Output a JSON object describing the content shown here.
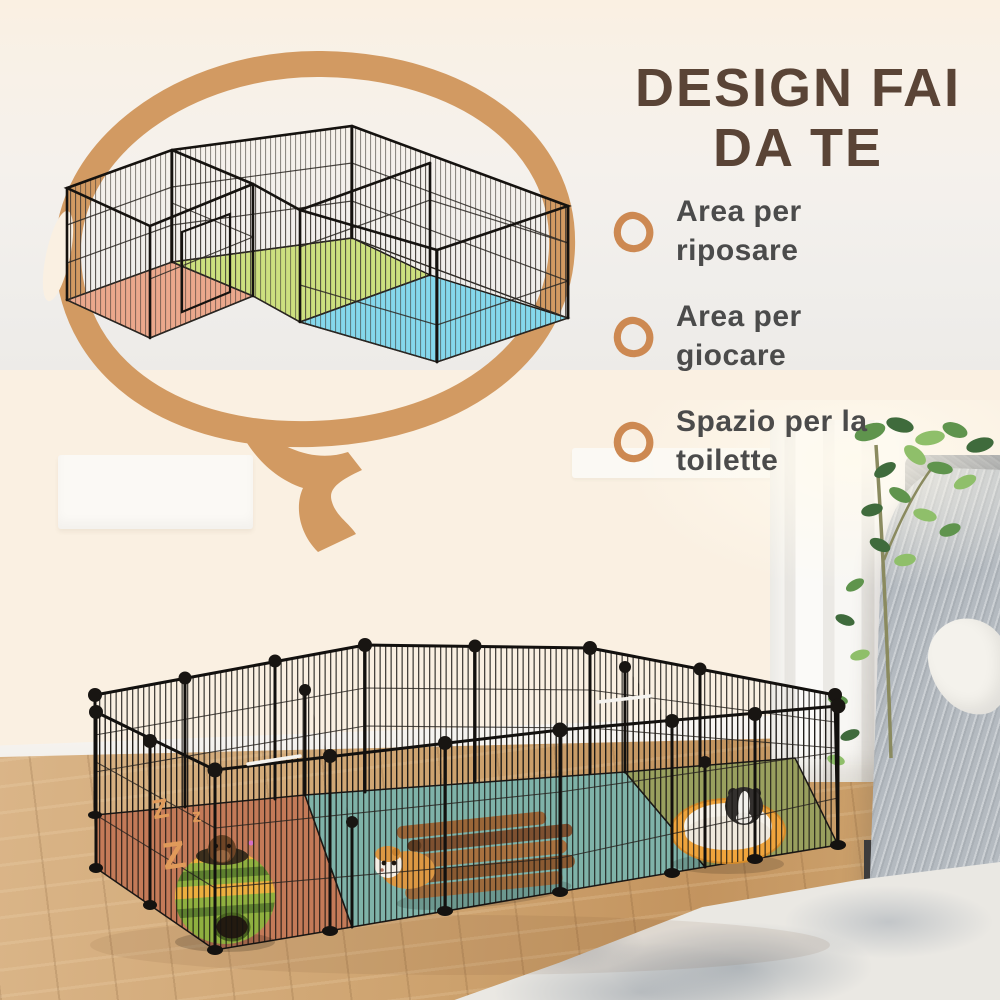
{
  "page": {
    "background_color": "#faf0e2",
    "language": "it"
  },
  "headline": {
    "line1": "DESIGN FAI",
    "line2": "DA TE",
    "text_color": "#5a4436"
  },
  "features": [
    {
      "label": "Area per riposare"
    },
    {
      "label": "Area per giocare"
    },
    {
      "label": "Spazio per la toilette"
    }
  ],
  "feature_text_color": "#4b4b4b",
  "feature_ring_color": "#cd8952",
  "speech_bubble_color": "#d29a62",
  "illustration_cage": {
    "mat_colors": {
      "left": "#eba88c",
      "middle": "#cde07f",
      "right": "#85d8ec"
    }
  },
  "photo": {
    "sleep_letters": [
      "Z",
      "z",
      "Z"
    ],
    "sleep_letter_color": "#e09a5a",
    "pen_mat_colors": {
      "left": "#c47a58",
      "middle": "#7fb3a9",
      "right": "#99a05e"
    }
  }
}
